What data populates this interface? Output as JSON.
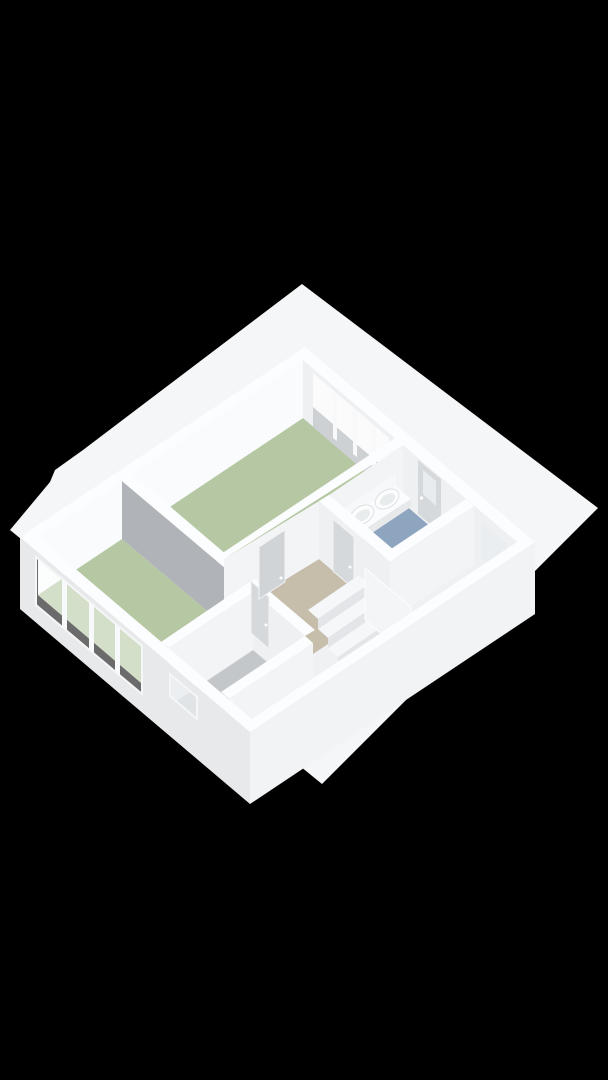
{
  "scene": {
    "description": "3D axonometric dollhouse floor-plan render of an apartment storey on a black background",
    "view": "isometric top-down, walls cut open, flat white roof slab extending beyond walls",
    "rooms": [
      {
        "name": "bedroom-large",
        "floor": "green",
        "features": [
          "window-band-northeast",
          "door-to-hall"
        ]
      },
      {
        "name": "bedroom-small",
        "floor": "green",
        "features": [
          "window-band-southwest"
        ]
      },
      {
        "name": "hallway-landing",
        "floor": "beige",
        "features": [
          "three-door-leaves",
          "stair-opening"
        ]
      },
      {
        "name": "bathroom",
        "floor": "blue",
        "features": [
          "twin-sinks-on-counter",
          "exterior-glazed-door",
          "small-window"
        ]
      },
      {
        "name": "shower-room",
        "floor": "grey",
        "features": [
          "floor-drain",
          "slot-window"
        ]
      },
      {
        "name": "staircase",
        "floor": "white",
        "features": [
          "four-treads-descending",
          "balustrade"
        ]
      }
    ],
    "fixtures": [
      "sink-left",
      "sink-right",
      "counter",
      "floor-drain",
      "stairs"
    ]
  },
  "colors": {
    "background": "#000000",
    "slab": "#f5f6f7",
    "floor_base": "#f0f1f2",
    "bedroom_floor": "#b6c8a3",
    "hall_floor": "#c6bdab",
    "bathroom_floor": "#8da5bf",
    "shower_floor": "#c4c7ca",
    "partition_face": "#b0b4b8",
    "partition_end": "#e8eaec",
    "wall_top": "#fcfdfe",
    "wall_inner_bright": "#fafbfc",
    "wall_inner_shaded": "#eef0f2",
    "wall_interior_lit": "#f3f4f6",
    "sill_band": "#ced1d4",
    "sw_wall": "#e7e9eb",
    "se_wall": "#f2f3f5",
    "glass_bright": "#ffffff",
    "glass_tint": "#e9edef",
    "mullion": "#f8f9fa",
    "door_leaf": "#d6d9db",
    "door_dark": "#d0d4d7",
    "counter": "#fbfcfd",
    "counter_edge": "#e7e9eb",
    "counter_end": "#e2e4e6",
    "backsplash": "#f7f8f9",
    "sink": "#fdfdfe",
    "sink_inner": "#e9eced",
    "stair_tread": "#f6f7f9",
    "stair_riser": "#e3e5e8",
    "balustrade": "#f4f5f7",
    "drain": "#b3b6b9",
    "handle": "#ffffff"
  }
}
